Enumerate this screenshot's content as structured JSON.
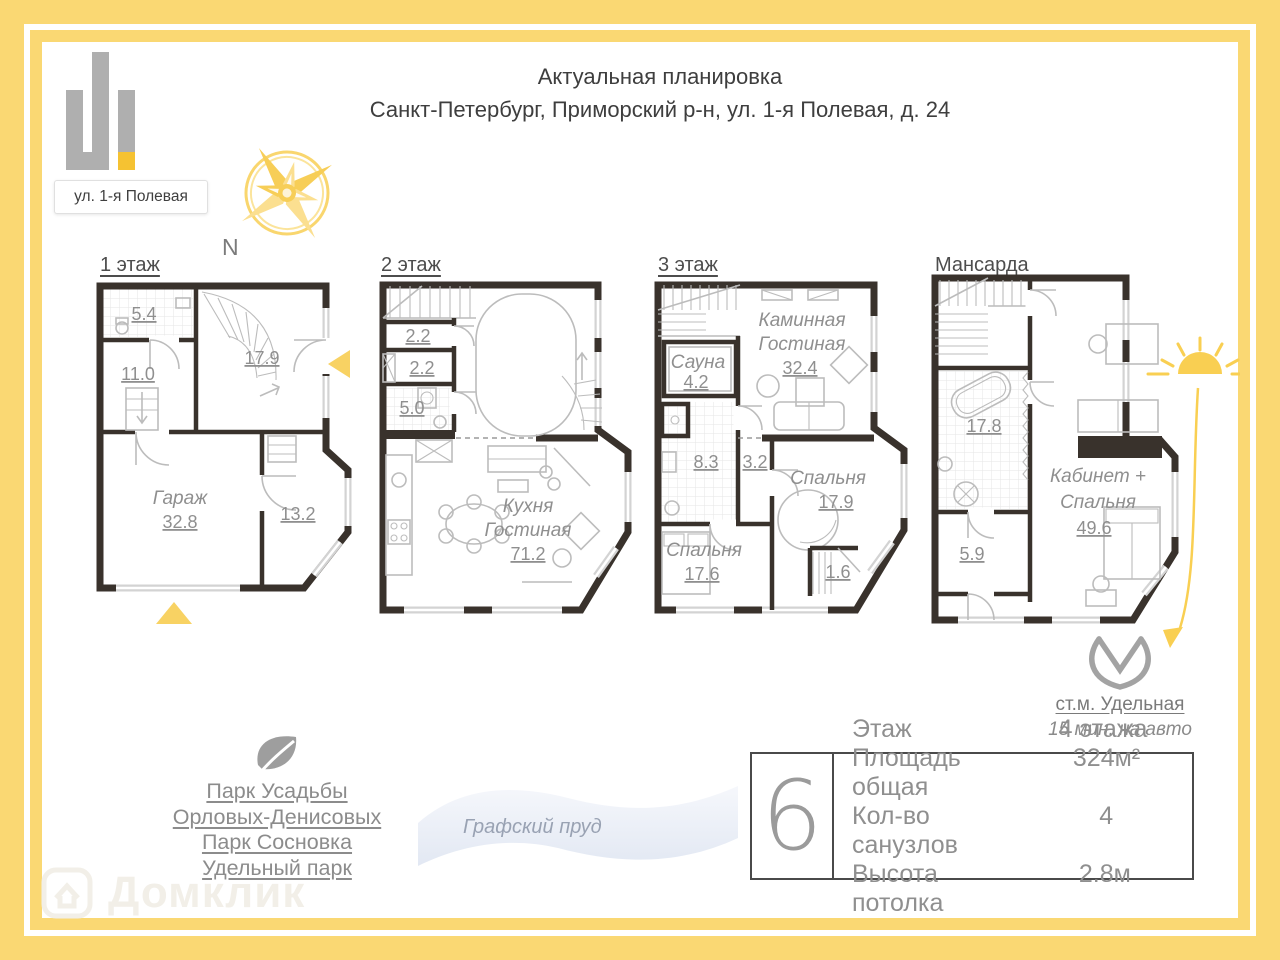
{
  "header": {
    "line1": "Актуальная планировка",
    "line2": "Санкт-Петербург, Приморский р-н, ул. 1-я Полевая, д. 24"
  },
  "logo": {
    "street": "ул. 1-я Полевая"
  },
  "compass": {
    "north": "N"
  },
  "floors": [
    {
      "title": "1 этаж",
      "labels": {
        "bath": "5.4",
        "hall": "11.0",
        "stair_hall": "17.9",
        "garage_name": "Гараж",
        "garage_area": "32.8",
        "room": "13.2"
      }
    },
    {
      "title": "2 этаж",
      "labels": {
        "wardrobe": "2.2",
        "closet": "2.2",
        "bath": "5.0",
        "kitchen_name1": "Кухня",
        "kitchen_name2": "Гостиная",
        "kitchen_area": "71.2"
      }
    },
    {
      "title": "3 этаж",
      "labels": {
        "living_name1": "Каминная",
        "living_name2": "Гостиная",
        "living_area": "32.4",
        "sauna_name": "Сауна",
        "sauna_area": "4.2",
        "bath": "8.3",
        "hall": "3.2",
        "bedroom1_name": "Спальня",
        "bedroom1_area": "17.9",
        "bedroom2_name": "Спальня",
        "bedroom2_area": "17.6",
        "closet": "1.6"
      }
    },
    {
      "title": "Мансарда",
      "labels": {
        "bath": "17.8",
        "laundry": "5.9",
        "cabinet_name1": "Кабинет +",
        "cabinet_name2": "Спальня",
        "cabinet_area": "49.6"
      }
    }
  ],
  "metro": {
    "station": "ст.м. Удельная",
    "drive_time": "15 мин. на авто"
  },
  "info_panel": {
    "big_number": "6",
    "rows": [
      {
        "label": "Этаж",
        "value": "4 этажа"
      },
      {
        "label": "Площадь общая",
        "value": "324м²"
      },
      {
        "label": "Кол-во санузлов",
        "value": "4"
      },
      {
        "label": "Высота потолка",
        "value": "2.8м"
      }
    ]
  },
  "parks": {
    "lines": [
      "Парк Усадьбы",
      "Орловых-Денисовых",
      "Парк Сосновка",
      "Удельный парк"
    ]
  },
  "pond": {
    "name": "Графский пруд"
  },
  "watermark": {
    "brand": "Домклик"
  },
  "colors": {
    "accent_yellow": "#FAD873",
    "logo_yellow": "#F5C232",
    "wall_dark": "#39322C",
    "text_gray": "#8F8F8F"
  }
}
